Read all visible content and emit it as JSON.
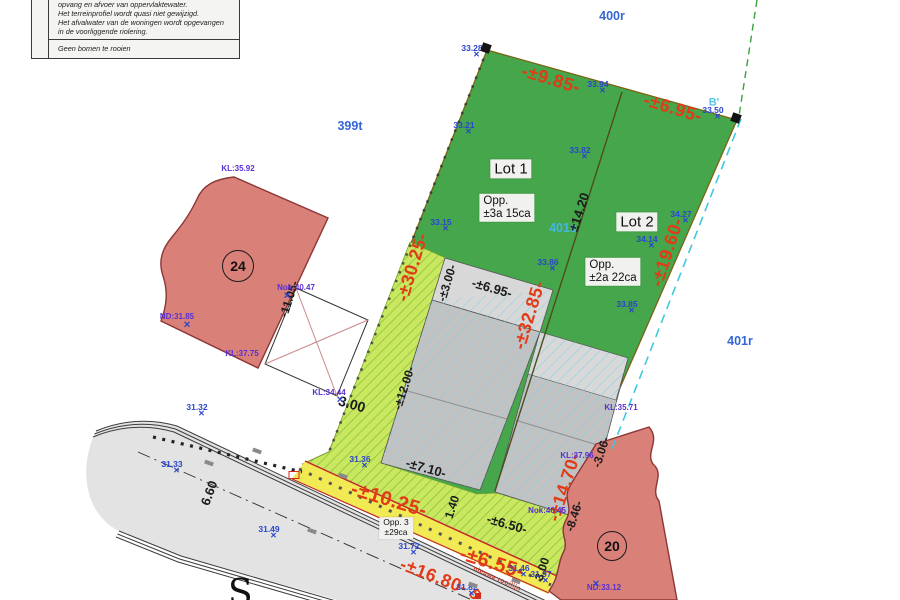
{
  "note_box": {
    "line1": "opvang en afvoer van oppervlaktewater.",
    "line2": "Het terreinprofiel wordt quasi niet gewijzigd.",
    "line3": "Het afvalwater van de woningen wordt opgevangen",
    "line4": "in de voorliggende riolering.",
    "footer": "Geen bomen te rooien"
  },
  "lots": {
    "lot1_title": "Lot 1",
    "lot1_area_1": "Opp.",
    "lot1_area_2": "±3a 15ca",
    "lot2_title": "Lot 2",
    "lot2_area_1": "Opp.",
    "lot2_area_2": "±2a 22ca",
    "lot3_title": "Opp. 3",
    "lot3_area": "±29ca"
  },
  "buildings": {
    "left_number": "24",
    "right_number": "20"
  },
  "rooilijn_label": "nieuwe rooilijn",
  "street_letter": "S",
  "colors": {
    "parcel_green": "#46a64b",
    "strip_green": "#c9e75f",
    "yellow_strip": "#f1ea55",
    "road_grey": "#e3e3e3",
    "building_grey": "#c2c2c2",
    "red_building": "#d98078",
    "dimension_red": "#e23b17",
    "point_blue": "#2a46cc",
    "level_purple": "#5a30cf"
  },
  "parcels": [
    {
      "t": "400r",
      "x": 612,
      "y": 16,
      "c": "parcel"
    },
    {
      "t": "399t",
      "x": 350,
      "y": 126,
      "c": "parcel"
    },
    {
      "t": "401s",
      "x": 563,
      "y": 228,
      "c": "parcel light"
    },
    {
      "t": "401r",
      "x": 740,
      "y": 341,
      "c": "parcel"
    },
    {
      "t": "B'",
      "x": 714,
      "y": 103,
      "c": "section"
    }
  ],
  "dims": [
    {
      "t": "-±9.85-",
      "x": 551,
      "y": 79,
      "r": 17,
      "c": "red"
    },
    {
      "t": "-±6.95-",
      "x": 673,
      "y": 108,
      "r": 17,
      "c": "red"
    },
    {
      "t": "-±30.25-",
      "x": 412,
      "y": 267,
      "r": -73,
      "c": "red"
    },
    {
      "t": "-±19.60-",
      "x": 667,
      "y": 252,
      "r": -72,
      "c": "red"
    },
    {
      "t": "-±32.85-",
      "x": 529,
      "y": 315,
      "r": -73,
      "c": "red"
    },
    {
      "t": "-±14.70-",
      "x": 564,
      "y": 487,
      "r": -72,
      "c": "red"
    },
    {
      "t": "-±10.25-",
      "x": 389,
      "y": 500,
      "r": 17,
      "c": "red",
      "s": 20
    },
    {
      "t": "-±6.55-",
      "x": 492,
      "y": 563,
      "r": 17,
      "c": "red",
      "s": 20
    },
    {
      "t": "-±16.80-",
      "x": 434,
      "y": 576,
      "r": 21,
      "c": "red"
    },
    {
      "t": "5",
      "x": 474,
      "y": 595,
      "r": 55,
      "c": "red",
      "s": 16
    },
    {
      "t": "-±3.00-",
      "x": 447,
      "y": 283,
      "r": -73,
      "c": "blk",
      "s": 12
    },
    {
      "t": "-±6.95-",
      "x": 492,
      "y": 288,
      "r": 16,
      "c": "blk"
    },
    {
      "t": "±14.20",
      "x": 579,
      "y": 212,
      "r": -72,
      "c": "blk"
    },
    {
      "t": "-±12.00-",
      "x": 404,
      "y": 388,
      "r": -72,
      "c": "blk",
      "s": 12
    },
    {
      "t": "3.00",
      "x": 352,
      "y": 404,
      "r": 16,
      "c": "blk",
      "s": 14
    },
    {
      "t": "-11.05-",
      "x": 289,
      "y": 299,
      "r": -72,
      "c": "blk",
      "s": 12
    },
    {
      "t": "-±7.10-",
      "x": 426,
      "y": 468,
      "r": 16,
      "c": "blk"
    },
    {
      "t": "1.40",
      "x": 452,
      "y": 507,
      "r": -72,
      "c": "blk",
      "s": 12
    },
    {
      "t": "-±6.50-",
      "x": 507,
      "y": 524,
      "r": 16,
      "c": "blk"
    },
    {
      "t": "-8.46-",
      "x": 574,
      "y": 516,
      "r": -72,
      "c": "blk",
      "s": 12
    },
    {
      "t": "3.00",
      "x": 542,
      "y": 569,
      "r": -72,
      "c": "blk",
      "s": 12
    },
    {
      "t": "-3.06-",
      "x": 601,
      "y": 452,
      "r": -72,
      "c": "blk",
      "s": 12
    },
    {
      "t": "6.60",
      "x": 209,
      "y": 493,
      "r": -70,
      "c": "blk"
    }
  ],
  "points": [
    {
      "t": "33.28",
      "x": 472,
      "y": 48,
      "c": "pt"
    },
    {
      "t": "33.94",
      "x": 598,
      "y": 84,
      "c": "pt"
    },
    {
      "t": "33.50",
      "x": 713,
      "y": 110,
      "c": "pt"
    },
    {
      "t": "33.21",
      "x": 464,
      "y": 125,
      "c": "pt"
    },
    {
      "t": "33.15",
      "x": 441,
      "y": 222,
      "c": "pt"
    },
    {
      "t": "33.82",
      "x": 580,
      "y": 150,
      "c": "pt"
    },
    {
      "t": "34.27",
      "x": 681,
      "y": 214,
      "c": "pt"
    },
    {
      "t": "34.14",
      "x": 647,
      "y": 239,
      "c": "pt"
    },
    {
      "t": "33.86",
      "x": 548,
      "y": 262,
      "c": "pt"
    },
    {
      "t": "33.85",
      "x": 627,
      "y": 304,
      "c": "pt"
    },
    {
      "t": "31.32",
      "x": 197,
      "y": 407,
      "c": "pt"
    },
    {
      "t": "31.33",
      "x": 172,
      "y": 464,
      "c": "pt"
    },
    {
      "t": "31.36",
      "x": 360,
      "y": 459,
      "c": "pt"
    },
    {
      "t": "31.49",
      "x": 269,
      "y": 529,
      "c": "pt"
    },
    {
      "t": "31.72",
      "x": 409,
      "y": 546,
      "c": "pt"
    },
    {
      "t": "31.46",
      "x": 519,
      "y": 568,
      "c": "pt"
    },
    {
      "t": "31.97",
      "x": 541,
      "y": 574,
      "c": "pt"
    },
    {
      "t": "31.82",
      "x": 467,
      "y": 587,
      "c": "pt"
    }
  ],
  "levels": [
    {
      "t": "KL:35.92",
      "x": 238,
      "y": 169,
      "c": "lvl"
    },
    {
      "t": "Nok:40.47",
      "x": 296,
      "y": 288,
      "c": "lvl"
    },
    {
      "t": "ND:31.85",
      "x": 177,
      "y": 317,
      "c": "lvl"
    },
    {
      "t": "KL:37.75",
      "x": 242,
      "y": 354,
      "c": "lvl"
    },
    {
      "t": "KL:34.44",
      "x": 329,
      "y": 393,
      "c": "lvl"
    },
    {
      "t": "KL:35.71",
      "x": 621,
      "y": 408,
      "c": "lvl"
    },
    {
      "t": "KL:37.96",
      "x": 577,
      "y": 456,
      "c": "lvl"
    },
    {
      "t": "Nok:40.45",
      "x": 547,
      "y": 511,
      "c": "lvl"
    },
    {
      "t": "ND:33.12",
      "x": 604,
      "y": 588,
      "c": "lvl"
    }
  ],
  "markers": [
    {
      "x": 486,
      "y": 48,
      "r": 20,
      "c": "mk-sq"
    },
    {
      "x": 736,
      "y": 118,
      "r": 20,
      "c": "mk-sq"
    },
    {
      "x": 294,
      "y": 475,
      "c": "mk-redopen"
    },
    {
      "x": 478,
      "y": 596,
      "c": "mk-redsq"
    },
    {
      "x": 187,
      "y": 325,
      "c": "mk-x"
    },
    {
      "x": 340,
      "y": 400,
      "c": "mk-x"
    },
    {
      "x": 287,
      "y": 296,
      "c": "mk-x"
    },
    {
      "x": 596,
      "y": 584,
      "c": "mk-x"
    },
    {
      "x": 257,
      "y": 451,
      "r": 20,
      "c": "mk-arr"
    },
    {
      "x": 209,
      "y": 463,
      "r": 20,
      "c": "mk-arr"
    },
    {
      "x": 343,
      "y": 476,
      "r": 20,
      "c": "mk-arr"
    },
    {
      "x": 312,
      "y": 531,
      "r": 20,
      "c": "mk-arr"
    },
    {
      "x": 473,
      "y": 585,
      "r": 20,
      "c": "mk-arr"
    },
    {
      "x": 516,
      "y": 581,
      "r": 20,
      "c": "mk-arr"
    }
  ]
}
